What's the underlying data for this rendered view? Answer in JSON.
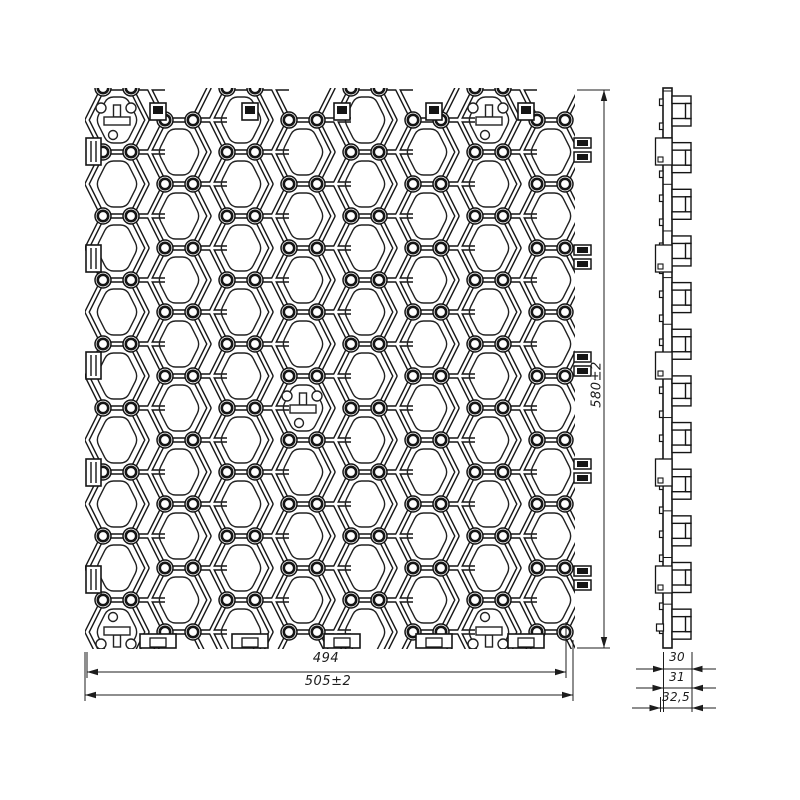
{
  "drawing": {
    "type": "technical-drawing",
    "subject": "grass-grid-paver-panel",
    "line_color": "#151515",
    "dim_color": "#1c1c1c",
    "background": "#ffffff"
  },
  "dimensions": {
    "height": {
      "label": "580±2"
    },
    "width_inner": {
      "label": "494"
    },
    "width_outer": {
      "label": "505±2"
    },
    "side_tooth": {
      "label": "30"
    },
    "side_mid": {
      "label": "31"
    },
    "side_total": {
      "label": "32,5"
    }
  },
  "geometry": {
    "panel": {
      "x": 85,
      "y": 88,
      "w": 490,
      "h": 560
    },
    "cell": {
      "pitch_x": 62,
      "pitch_y": 64,
      "half_w": 30,
      "top_half_w": 14,
      "half_h": 32,
      "open_half_w": 21,
      "open_top_half_w": 9.5,
      "open_half_h": 23,
      "open_corner_r": 6,
      "post_r": 8,
      "post_inner_r": 5.2
    },
    "cols": 8,
    "t_mark_cells": [
      [
        0,
        0,
        0
      ],
      [
        6,
        0,
        0
      ],
      [
        3,
        4,
        0
      ],
      [
        0,
        8,
        1
      ],
      [
        6,
        8,
        1
      ]
    ],
    "top_clips_x": [
      158,
      250,
      342,
      434,
      526
    ],
    "bottom_tabs_x": [
      158,
      250,
      342,
      434,
      526
    ],
    "left_clips_y": [
      138,
      245,
      352,
      459,
      566
    ],
    "right_clips_y": [
      138,
      245,
      352,
      459,
      566
    ],
    "side_view": {
      "x": 663,
      "y": 88,
      "wall_w": 9,
      "teeth_w": 20,
      "h": 560,
      "tooth_units": 12,
      "unit_h": 46.65,
      "nub_pitch": 24,
      "boxes_y": [
        138,
        245,
        352,
        459,
        566
      ]
    }
  }
}
